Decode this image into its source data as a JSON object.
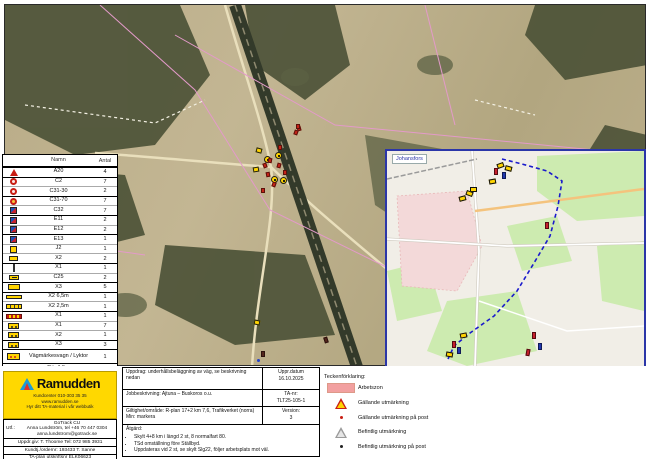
{
  "legend_table": {
    "headers": {
      "name": "Namn",
      "count": "Antal"
    },
    "rows": [
      {
        "icon": "tri",
        "name": "A20",
        "count": "4",
        "sep": true
      },
      {
        "icon": "circ",
        "name": "C2",
        "count": "7",
        "sep": true
      },
      {
        "icon": "circ",
        "name": "C31-30",
        "count": "2"
      },
      {
        "icon": "circ-o",
        "name": "C31-70",
        "count": "7",
        "sep": true
      },
      {
        "icon": "sq-br",
        "name": "C32",
        "count": "7"
      },
      {
        "icon": "sq-br",
        "name": "E11",
        "count": "2",
        "sep": true
      },
      {
        "icon": "sq-br",
        "name": "E12",
        "count": "2"
      },
      {
        "icon": "sq-br",
        "name": "E13",
        "count": "1",
        "sep": true
      },
      {
        "icon": "yel-h",
        "name": "J2",
        "count": "1"
      },
      {
        "icon": "yel",
        "name": "X2",
        "count": "2"
      },
      {
        "icon": "post",
        "name": "X1",
        "count": "1",
        "sep": true
      },
      {
        "icon": "yel-arrow",
        "name": "C25",
        "count": "2"
      },
      {
        "icon": "yel-wide",
        "name": "X3",
        "count": "5",
        "sep": true
      },
      {
        "icon": "yel-long",
        "name": "X2 6,5m",
        "count": "1",
        "sep": true
      },
      {
        "icon": "yel-long2",
        "name": "X2 2,5m",
        "count": "1"
      },
      {
        "icon": "stripe",
        "name": "X1",
        "count": "1",
        "sep": true
      },
      {
        "icon": "yel-dot",
        "name": "X1",
        "count": "7"
      },
      {
        "icon": "yel-dot",
        "name": "X2",
        "count": "1"
      },
      {
        "icon": "yel-dot",
        "name": "X3",
        "count": "3",
        "sep": true
      },
      {
        "icon": "vagn",
        "name": "Vägmärkesvagn / Lyktor",
        "count": "1",
        "sep": true,
        "tall": true
      },
      {
        "icon": "flag-r",
        "name": "Rör 1,5m",
        "count": "23",
        "sep": true
      },
      {
        "icon": "flag-b",
        "name": "Markör",
        "count": "1"
      },
      {
        "icon": "vmark",
        "name": "Prickmarkering",
        "count": "3"
      }
    ]
  },
  "inset": {
    "label": "Johansfors"
  },
  "ramudden": {
    "brand": "Ramudden",
    "line1": "Kundcenter 010-303 35 35",
    "line2": "www.ramudden.se",
    "line3": "Hyr ditt TA-material i vår webbutik"
  },
  "contact": {
    "label": "Utf.:",
    "company": "GoTrack CU",
    "phone": "Anna Lundström, tel +46 70 447 0304",
    "email": "anna.lundstrom@gotrack.se",
    "row2": "Uppdr.giv: T. Thoome  Tel: 072 985 3931",
    "row3": "Kundtj./ordernr: 193433 T. Sanne",
    "row4": "TA-plan utskriftsnr ELK06623"
  },
  "titleblock": {
    "r1_left": "Uppdrag: underhållsbeläggning av väg, se beskrivning nedan",
    "r1_right_label": "Uppr.datum",
    "r1_right_value": "16.10.2025",
    "r2_left": "Jobbeskrivning: Ajtuna – Buskoros o.u.",
    "r2_right_label": "TA-nr:",
    "r2_right_value": "TLT25-105-1",
    "r3_left": "Giltighet/område: R-plan 17+2 km 7,6, Trafikverket (norra) Min: markera",
    "r3_right_label": "Version:",
    "r3_right_value": "3",
    "r4_header": "Åtgärd:",
    "bullets": [
      "Skylt 4+8 km i längd 2 st, 8 normalfart 80.",
      "TSd omställning före Ställbyd.",
      "Uppdateras vid 2 st, se skylt Slg22, följer arbetsplats mot väl."
    ]
  },
  "map_legend": {
    "title": "Teckenförklaring:",
    "items": [
      {
        "icon": "area-pink",
        "label": "Arbetszon"
      },
      {
        "icon": "triangle-warning",
        "label": "Gällande utmärkning"
      },
      {
        "icon": "dot-red",
        "label": "Gällande utmärkning på post"
      },
      {
        "icon": "triangle-gray",
        "label": "Befintlig utmärkning"
      },
      {
        "icon": "dot-dark",
        "label": "Befintlig utmärkning på post"
      }
    ]
  },
  "colors": {
    "brand_yellow": "#ffd800",
    "work_zone_pink": "#f2a0a0",
    "route_blue": "#1a1acc",
    "sign_yellow": "#ffd400",
    "sign_red": "#c81e14"
  },
  "markers": {
    "main": [
      [
        "yc",
        275,
        152,
        0
      ],
      [
        "yc",
        264,
        156,
        0
      ],
      [
        "yc",
        271,
        176,
        0
      ],
      [
        "yc",
        280,
        177,
        0
      ],
      [
        "yr",
        256,
        148,
        15
      ],
      [
        "yr",
        253,
        167,
        -10
      ],
      [
        "red",
        294,
        130,
        20
      ],
      [
        "red",
        297,
        126,
        -15
      ],
      [
        "red",
        278,
        145,
        0
      ],
      [
        "red",
        268,
        158,
        10
      ],
      [
        "red",
        263,
        163,
        -20
      ],
      [
        "red",
        277,
        163,
        15
      ],
      [
        "red",
        283,
        170,
        0
      ],
      [
        "red",
        266,
        172,
        -10
      ],
      [
        "red",
        272,
        182,
        20
      ],
      [
        "red",
        261,
        188,
        0
      ],
      [
        "yr",
        254,
        320,
        12
      ],
      [
        "dark",
        261,
        351,
        0
      ],
      [
        "bd",
        257,
        359,
        0
      ],
      [
        "dark",
        324,
        337,
        -18
      ],
      [
        "red",
        296,
        124,
        0
      ]
    ],
    "inset": [
      [
        "iy",
        497,
        163,
        -20
      ],
      [
        "iy",
        505,
        166,
        15
      ],
      [
        "iy",
        489,
        179,
        -10
      ],
      [
        "iy",
        470,
        187,
        0
      ],
      [
        "iy",
        466,
        191,
        20
      ],
      [
        "iy",
        459,
        196,
        -15
      ],
      [
        "iy",
        460,
        333,
        -12
      ],
      [
        "iy",
        446,
        352,
        10
      ],
      [
        "ir",
        494,
        168,
        0
      ],
      [
        "ir",
        545,
        222,
        0
      ],
      [
        "ir",
        532,
        332,
        0
      ],
      [
        "ir",
        526,
        349,
        10
      ],
      [
        "ir",
        452,
        341,
        0
      ],
      [
        "ib",
        502,
        172,
        0
      ],
      [
        "ib",
        538,
        343,
        0
      ],
      [
        "ib",
        457,
        347,
        0
      ]
    ]
  }
}
